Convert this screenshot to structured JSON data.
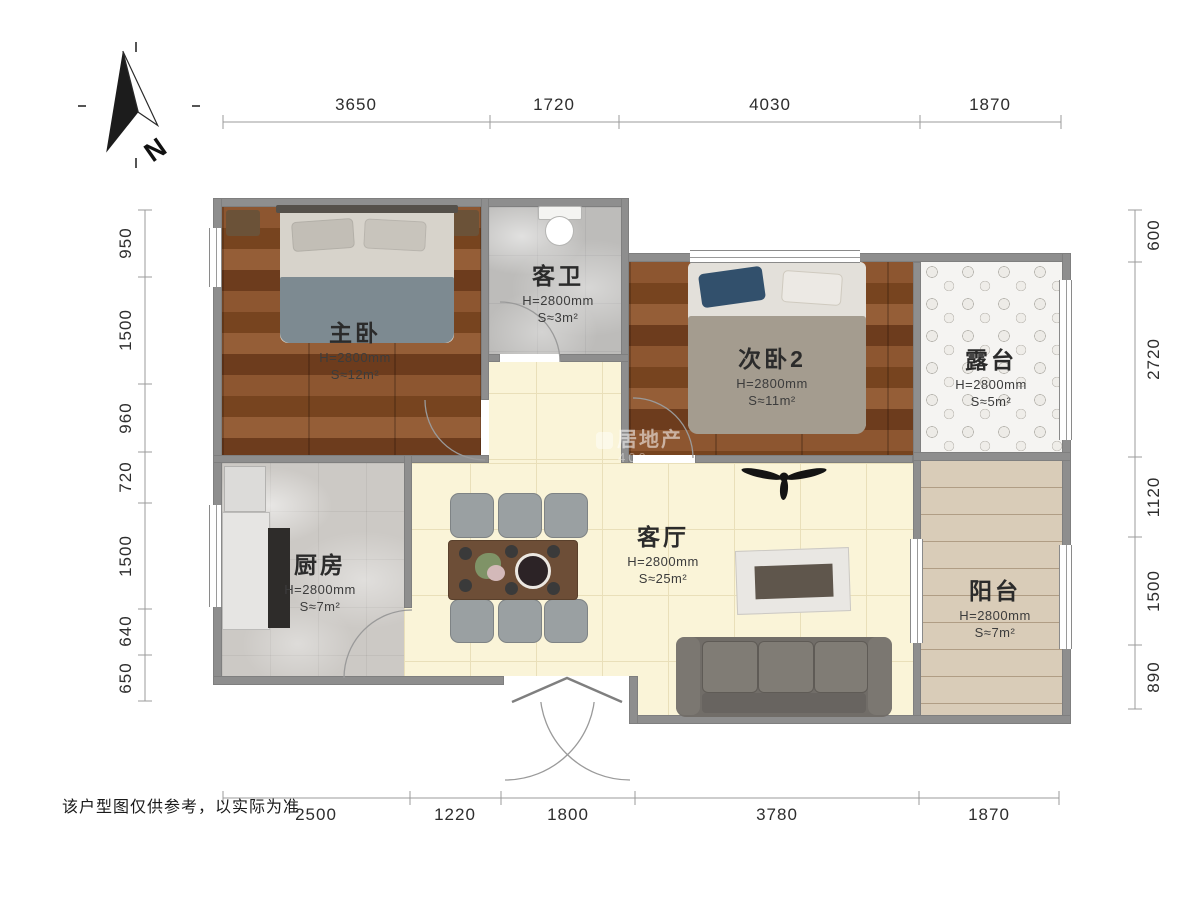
{
  "compass": {
    "label": "N"
  },
  "disclaimer": "该户型图仅供参考，以实际为准",
  "watermark": {
    "line1": "居地产",
    "line2": "400"
  },
  "dimensions": {
    "top": [
      "3650",
      "1720",
      "4030",
      "1870"
    ],
    "bottom": [
      "2500",
      "1220",
      "1800",
      "3780",
      "1870"
    ],
    "left": [
      "950",
      "1500",
      "960",
      "720",
      "1500",
      "640",
      "650"
    ],
    "right": [
      "600",
      "2720",
      "1120",
      "1500",
      "890"
    ]
  },
  "rooms": {
    "master": {
      "name": "主卧",
      "height": "H=2800mm",
      "area": "S≈12m²"
    },
    "bath": {
      "name": "客卫",
      "height": "H=2800mm",
      "area": "S≈3m²"
    },
    "bed2": {
      "name": "次卧2",
      "height": "H=2800mm",
      "area": "S≈11m²"
    },
    "terrace": {
      "name": "露台",
      "height": "H=2800mm",
      "area": "S≈5m²"
    },
    "kitchen": {
      "name": "厨房",
      "height": "H=2800mm",
      "area": "S≈7m²"
    },
    "living": {
      "name": "客厅",
      "height": "H=2800mm",
      "area": "S≈25m²"
    },
    "balcony": {
      "name": "阳台",
      "height": "H=2800mm",
      "area": "S≈7m²"
    }
  }
}
